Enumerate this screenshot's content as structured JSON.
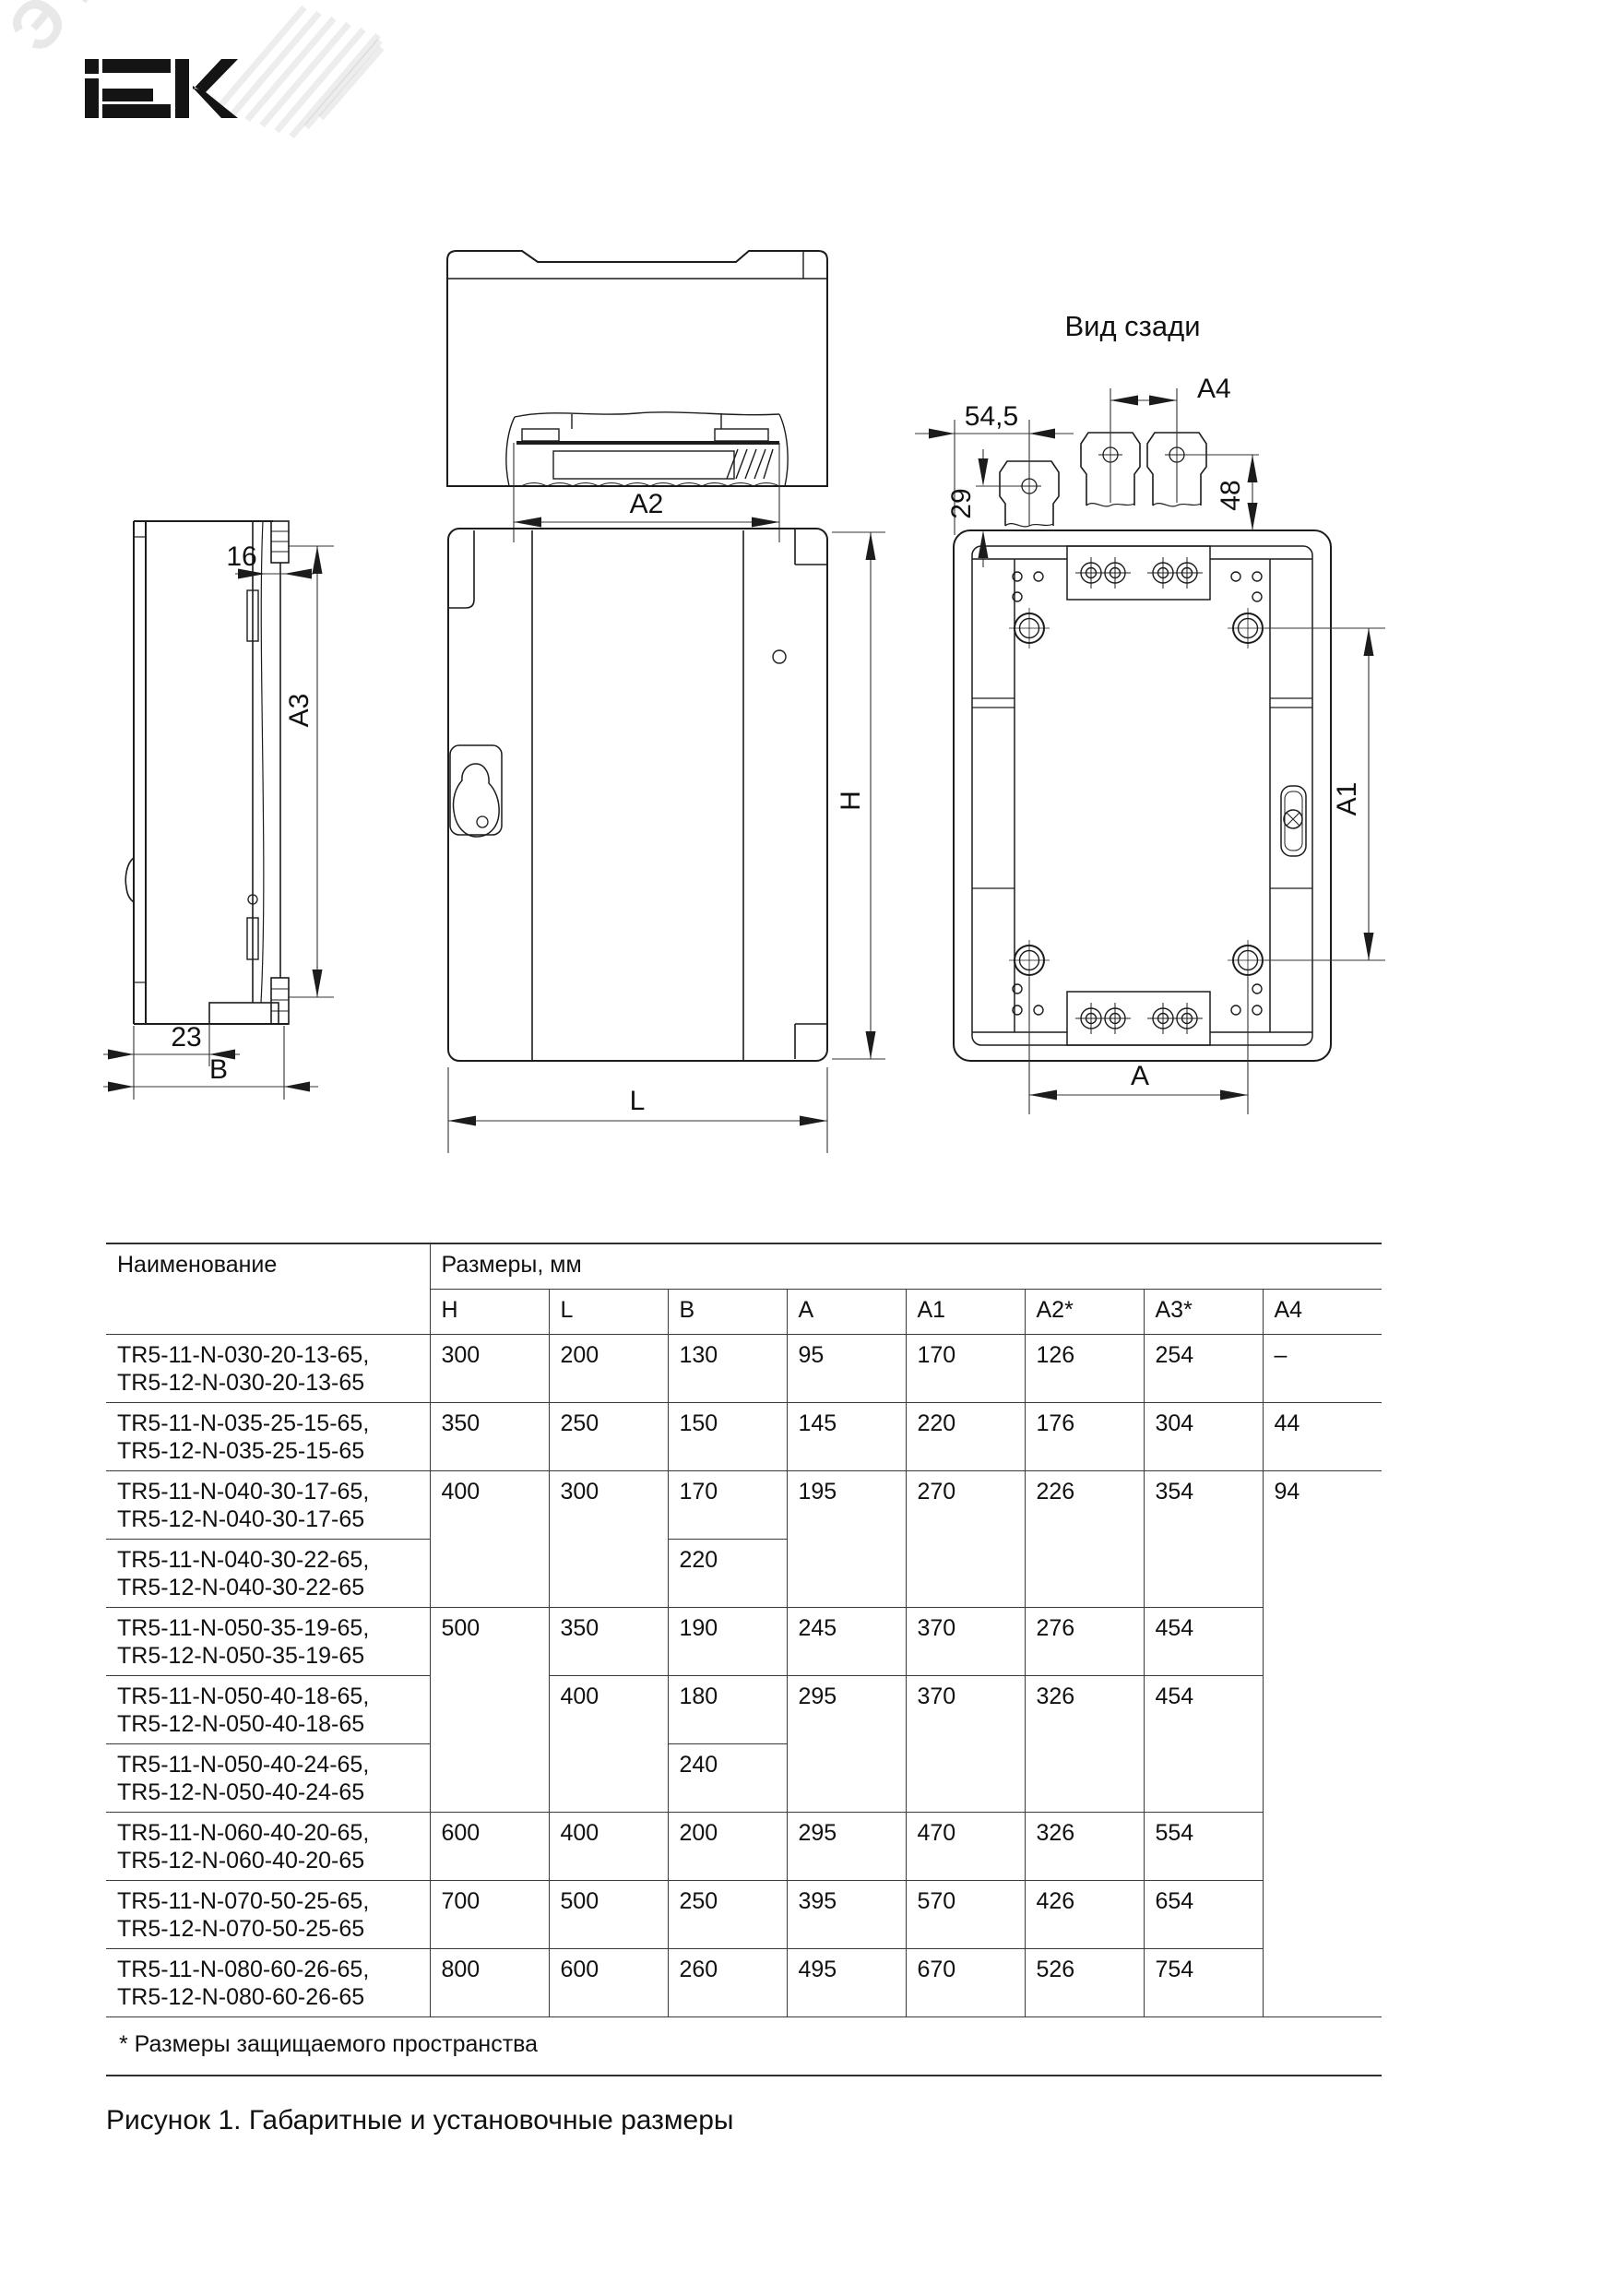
{
  "brand": {
    "logo_text": "IEK",
    "watermark_text": "ЭТМ"
  },
  "figure": {
    "back_view_title": "Вид сзади",
    "caption": "Рисунок 1. Габаритные и установочные размеры",
    "labels": {
      "a2": "A2",
      "a3": "A3",
      "a4": "A4",
      "a1": "A1",
      "a": "A",
      "h": "H",
      "l": "L",
      "b": "B",
      "d16": "16",
      "d23": "23",
      "d29": "29",
      "d48": "48",
      "d545": "54,5"
    }
  },
  "table": {
    "name_header": "Наименование",
    "group_header": "Размеры, мм",
    "sub_headers": [
      "H",
      "L",
      "B",
      "A",
      "A1",
      "A2*",
      "A3*",
      "A4"
    ],
    "rows": [
      {
        "n1": "TR5-11-N-030-20-13-65,",
        "n2": "TR5-12-N-030-20-13-65",
        "H": "300",
        "L": "200",
        "B": "130",
        "A": "95",
        "A1": "170",
        "A2": "126",
        "A3": "254",
        "A4": "–"
      },
      {
        "n1": "TR5-11-N-035-25-15-65,",
        "n2": "TR5-12-N-035-25-15-65",
        "H": "350",
        "L": "250",
        "B": "150",
        "A": "145",
        "A1": "220",
        "A2": "176",
        "A3": "304",
        "A4": "44"
      },
      {
        "n1": "TR5-11-N-040-30-17-65,",
        "n2": "TR5-12-N-040-30-17-65",
        "H": "400",
        "L": "300",
        "B": "170",
        "A": "195",
        "A1": "270",
        "A2": "226",
        "A3": "354",
        "A4": "94"
      },
      {
        "n1": "TR5-11-N-040-30-22-65,",
        "n2": "TR5-12-N-040-30-22-65",
        "B": "220"
      },
      {
        "n1": "TR5-11-N-050-35-19-65,",
        "n2": "TR5-12-N-050-35-19-65",
        "H": "500",
        "L": "350",
        "B": "190",
        "A": "245",
        "A1": "370",
        "A2": "276",
        "A3": "454"
      },
      {
        "n1": "TR5-11-N-050-40-18-65,",
        "n2": "TR5-12-N-050-40-18-65",
        "L": "400",
        "B": "180",
        "A": "295",
        "A1": "370",
        "A2": "326",
        "A3": "454"
      },
      {
        "n1": "TR5-11-N-050-40-24-65,",
        "n2": "TR5-12-N-050-40-24-65",
        "B": "240"
      },
      {
        "n1": "TR5-11-N-060-40-20-65,",
        "n2": "TR5-12-N-060-40-20-65",
        "H": "600",
        "L": "400",
        "B": "200",
        "A": "295",
        "A1": "470",
        "A2": "326",
        "A3": "554"
      },
      {
        "n1": "TR5-11-N-070-50-25-65,",
        "n2": "TR5-12-N-070-50-25-65",
        "H": "700",
        "L": "500",
        "B": "250",
        "A": "395",
        "A1": "570",
        "A2": "426",
        "A3": "654"
      },
      {
        "n1": "TR5-11-N-080-60-26-65,",
        "n2": "TR5-12-N-080-60-26-65",
        "H": "800",
        "L": "600",
        "B": "260",
        "A": "495",
        "A1": "670",
        "A2": "526",
        "A3": "754"
      }
    ],
    "footnote": "* Размеры защищаемого пространства"
  }
}
